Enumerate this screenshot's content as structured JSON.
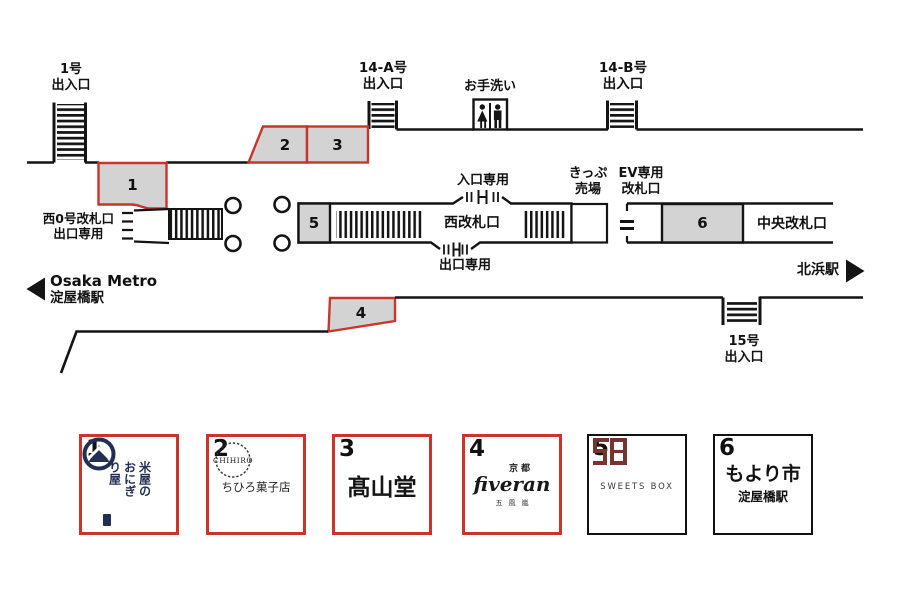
{
  "map": {
    "exits": {
      "exit1": {
        "line1": "1号",
        "line2": "出入口"
      },
      "exit14a": {
        "line1": "14-A号",
        "line2": "出入口"
      },
      "exit14b": {
        "line1": "14-B号",
        "line2": "出入口"
      },
      "exit15": {
        "line1": "15号",
        "line2": "出入口"
      }
    },
    "labels": {
      "restroom": "お手洗い",
      "west0_line1": "西0号改札口",
      "west0_line2": "出口専用",
      "entrance_only": "入口専用",
      "exit_only": "出口専用",
      "ticket_line1": "きっぷ",
      "ticket_line2": "売場",
      "ev_line1": "EV専用",
      "ev_line2": "改札口",
      "west_gate": "西改札口",
      "central_gate": "中央改札口",
      "station_left_line1": "Osaka Metro",
      "station_left_line2": "淀屋橋駅",
      "station_right": "北浜駅"
    },
    "markers": {
      "m1": "1",
      "m2": "2",
      "m3": "3",
      "m4": "4",
      "m5": "5",
      "m6": "6"
    }
  },
  "shops": [
    {
      "number": "1",
      "logo_text": "米屋の\nおにぎ\nり屋"
    },
    {
      "number": "2",
      "logo_title": "CHIHIRO",
      "name": "ちひろ菓子店"
    },
    {
      "number": "3",
      "name": "髙山堂"
    },
    {
      "number": "4",
      "region": "京都",
      "name": "fiveran",
      "sub": "五風嵐"
    },
    {
      "number": "5",
      "name": "SWEETS BOX"
    },
    {
      "number": "6",
      "name": "もより市",
      "sub": "淀屋橋駅"
    }
  ],
  "colors": {
    "accent_red": "#c9352c",
    "box_fill": "#d3d3d3",
    "line_black": "#141414",
    "navy": "#232f52",
    "maroon": "#73362e"
  }
}
